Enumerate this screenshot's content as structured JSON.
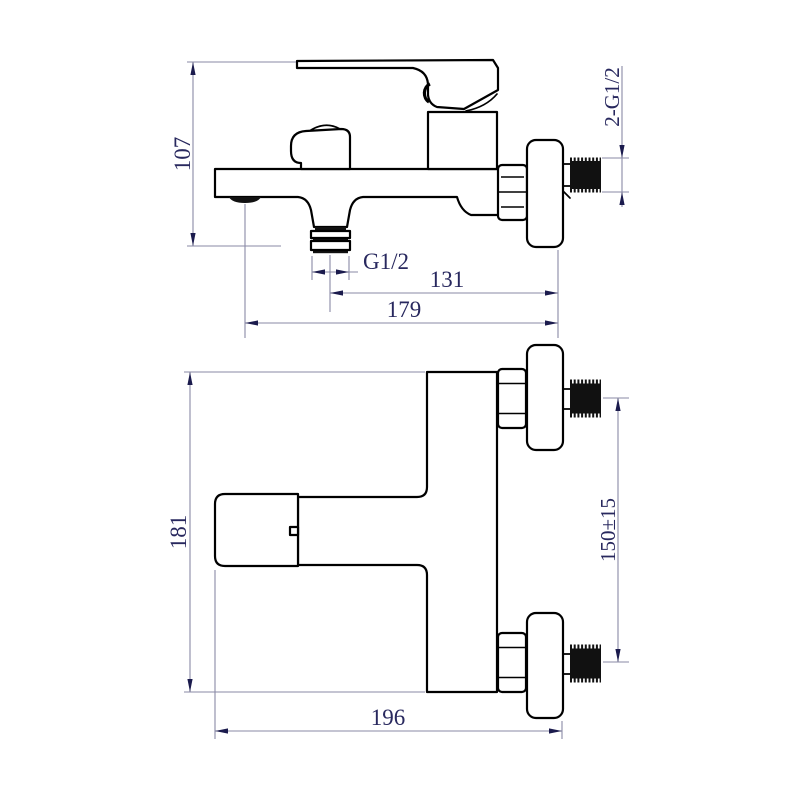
{
  "drawing": {
    "type": "technical-dimension-drawing",
    "subject": "wall-mounted bath mixer faucet, two orthographic views",
    "side_view": {
      "dimensions": {
        "overall_height": "107",
        "spout_outlet_thread": "G1/2",
        "outlet_to_wall": "131",
        "overall_depth": "179",
        "wall_connection_thread": "2-G1/2"
      }
    },
    "front_view": {
      "dimensions": {
        "overall_height": "181",
        "inlet_center_spacing": "150±15",
        "overall_width": "196"
      }
    },
    "colors": {
      "background": "#ffffff",
      "outline": "#000000",
      "dimension_line": "#8a8aa6",
      "dimension_text": "#28285e",
      "arrow_fill": "#1b1b4d",
      "thread_fill": "#111111"
    }
  }
}
